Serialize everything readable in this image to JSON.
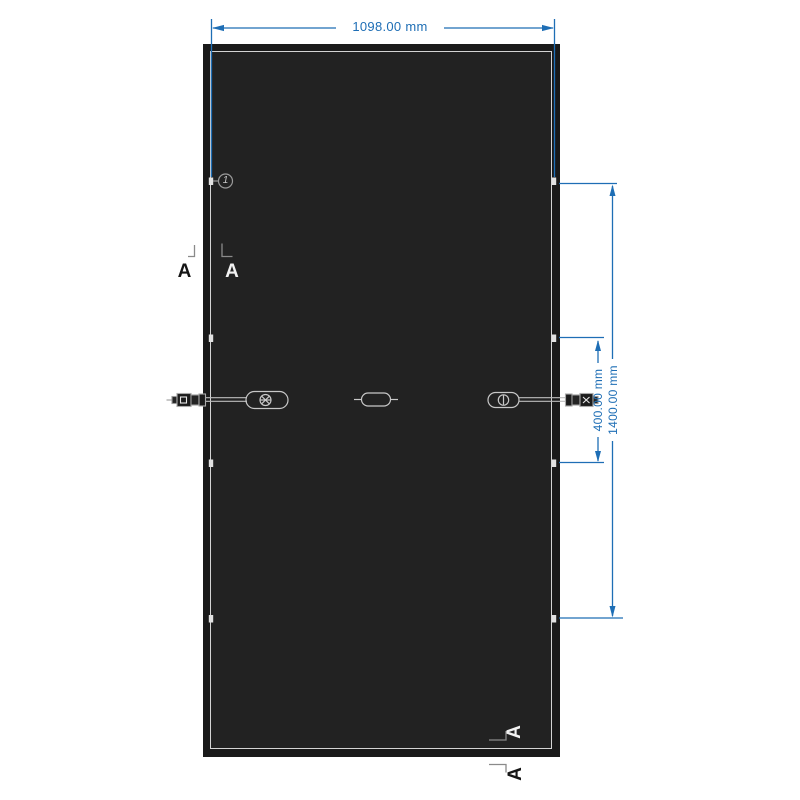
{
  "drawing": {
    "dim_width_label": "1098.00 mm",
    "dim_vertical_inner_label": "400.00 mm",
    "dim_vertical_outer_label": "1400.00 mm",
    "callout_number": "1",
    "section_letter": "A",
    "colors": {
      "dimension_blue": "#1e6eb5",
      "panel_frame": "#1a1a1a",
      "panel_surface": "#222222",
      "frame_highlight": "#d4d4d4",
      "detail_gray": "#b4b4b4"
    }
  }
}
